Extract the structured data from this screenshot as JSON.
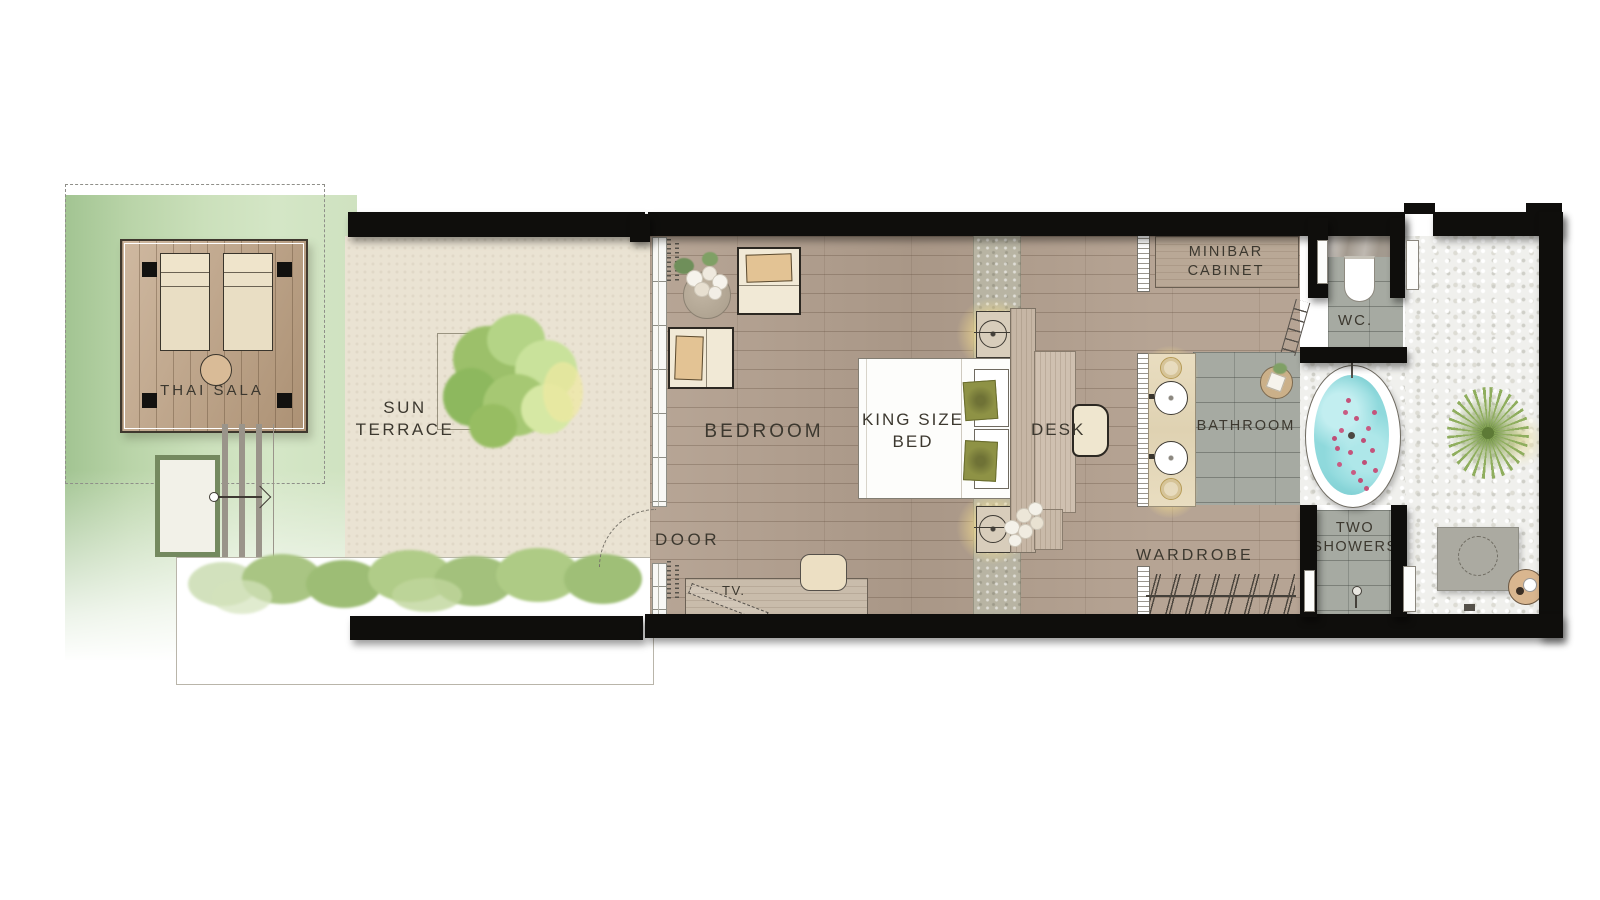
{
  "plan": {
    "labels": {
      "thai_sala": "THAI SALA",
      "sun_terrace": "SUN TERRACE",
      "bedroom": "BEDROOM",
      "king_bed": "KING SIZE BED",
      "desk": "DESK",
      "door": "DOOR",
      "tv": "TV.",
      "minibar": "MINIBAR CABINET",
      "wc": "WC.",
      "bathroom": "BATHROOM",
      "two_showers": "TWO SHOWERS",
      "wardrobe": "WARDROBE"
    },
    "palette": {
      "wall_black": "#0f0e0c",
      "label_text": "#3c382f",
      "wood_floor": "#b29f8e",
      "deck_wood": "#bfa181",
      "lawn_green": "#b3cfa4",
      "terrace_beige": "#eae3d3",
      "tile_grey": "#a6aaa2",
      "pebble_white": "#f0f0ed",
      "bath_water": "#8fd9dc",
      "petal_pink": "#c4537b",
      "hedge_green": "#a8c585",
      "cushion_olive": "#8e9245",
      "upholstery_cream": "#f1e9d6",
      "pillow_tan": "#e3c394"
    }
  }
}
